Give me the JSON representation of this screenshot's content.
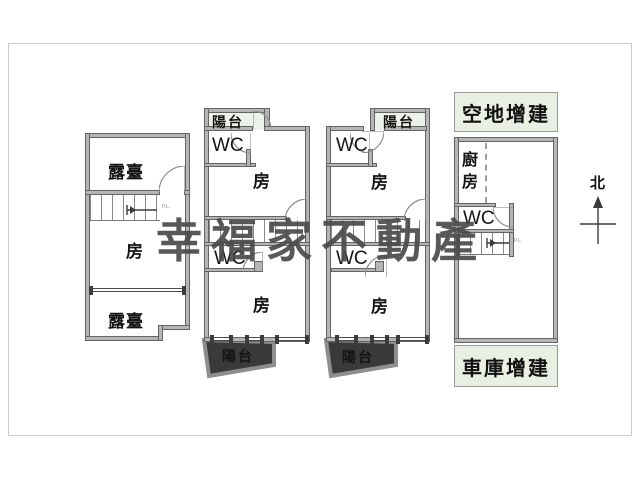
{
  "watermark": {
    "text": "幸福家不動產",
    "color": "#4a4a4a"
  },
  "compass": {
    "north_label": "北"
  },
  "stairs_note": "P.L.",
  "unit_left": {
    "terrace_top": "露臺",
    "room": "房",
    "terrace_bottom": "露臺"
  },
  "unit_mid1": {
    "balcony_top": "陽台",
    "wc_upper": "WC",
    "room_upper": "房",
    "wc_lower": "WC",
    "room_lower": "房",
    "balcony_bottom": "陽台"
  },
  "unit_mid2": {
    "balcony_top": "陽台",
    "wc_upper": "WC",
    "room_upper": "房",
    "wc_lower": "WC",
    "room_lower": "房",
    "balcony_bottom": "陽台"
  },
  "unit_right": {
    "annex_top": "空地增建",
    "kitchen": "廚房",
    "wc": "WC",
    "annex_bottom": "車庫增建"
  },
  "icons": {
    "door": "door-arc-icon",
    "stairs": "stairs-icon",
    "window": "window-icon",
    "compass": "north-arrow-icon"
  },
  "colors": {
    "wall_fill": "#b5b5b5",
    "wall_edge": "#646464",
    "annex_fill": "#eaefe4",
    "balcony_fill": "#edf2e8",
    "line": "#8f8f8f",
    "watermark": "#4a4a4a",
    "frame_border": "#cbcbcb"
  }
}
